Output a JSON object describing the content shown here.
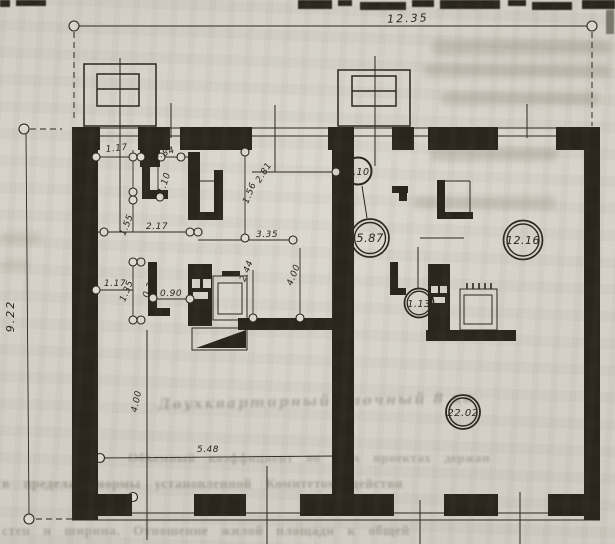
{
  "page": {
    "description": "Scanned book page with architectural floor plan of a two-apartment dwelling",
    "paper_color": "#d9d5cc",
    "ink_color": "#26211a"
  },
  "dims": {
    "top": "12.35",
    "left": "9.22",
    "bottom": "5.48"
  },
  "sd": {
    "w117a": "1.17",
    "w084": "0.84",
    "w110": "1.10",
    "w155": "1.55",
    "w217": "2.17",
    "w156": "1.56",
    "w281": "2.81",
    "w335": "3.35",
    "w244": "2.44",
    "w400a": "4.00",
    "w117b": "1.17",
    "w135": "1.35",
    "w025": "0.25",
    "w090": "0.90",
    "w400b": "4.00"
  },
  "areas": {
    "a110": "1.10",
    "a587": "5.87",
    "a113": "1.13",
    "a1216": "12.16",
    "a2202": "22.02"
  },
  "st": {
    "caption": "Двухквартирный блочный 8 кв",
    "p1": "Объемный коэффициент во всех проектах держан",
    "p2": "в пределах нормы установленной Комитетом действи",
    "p3": "стен и ширина. Отношение жилой площади к общей"
  }
}
